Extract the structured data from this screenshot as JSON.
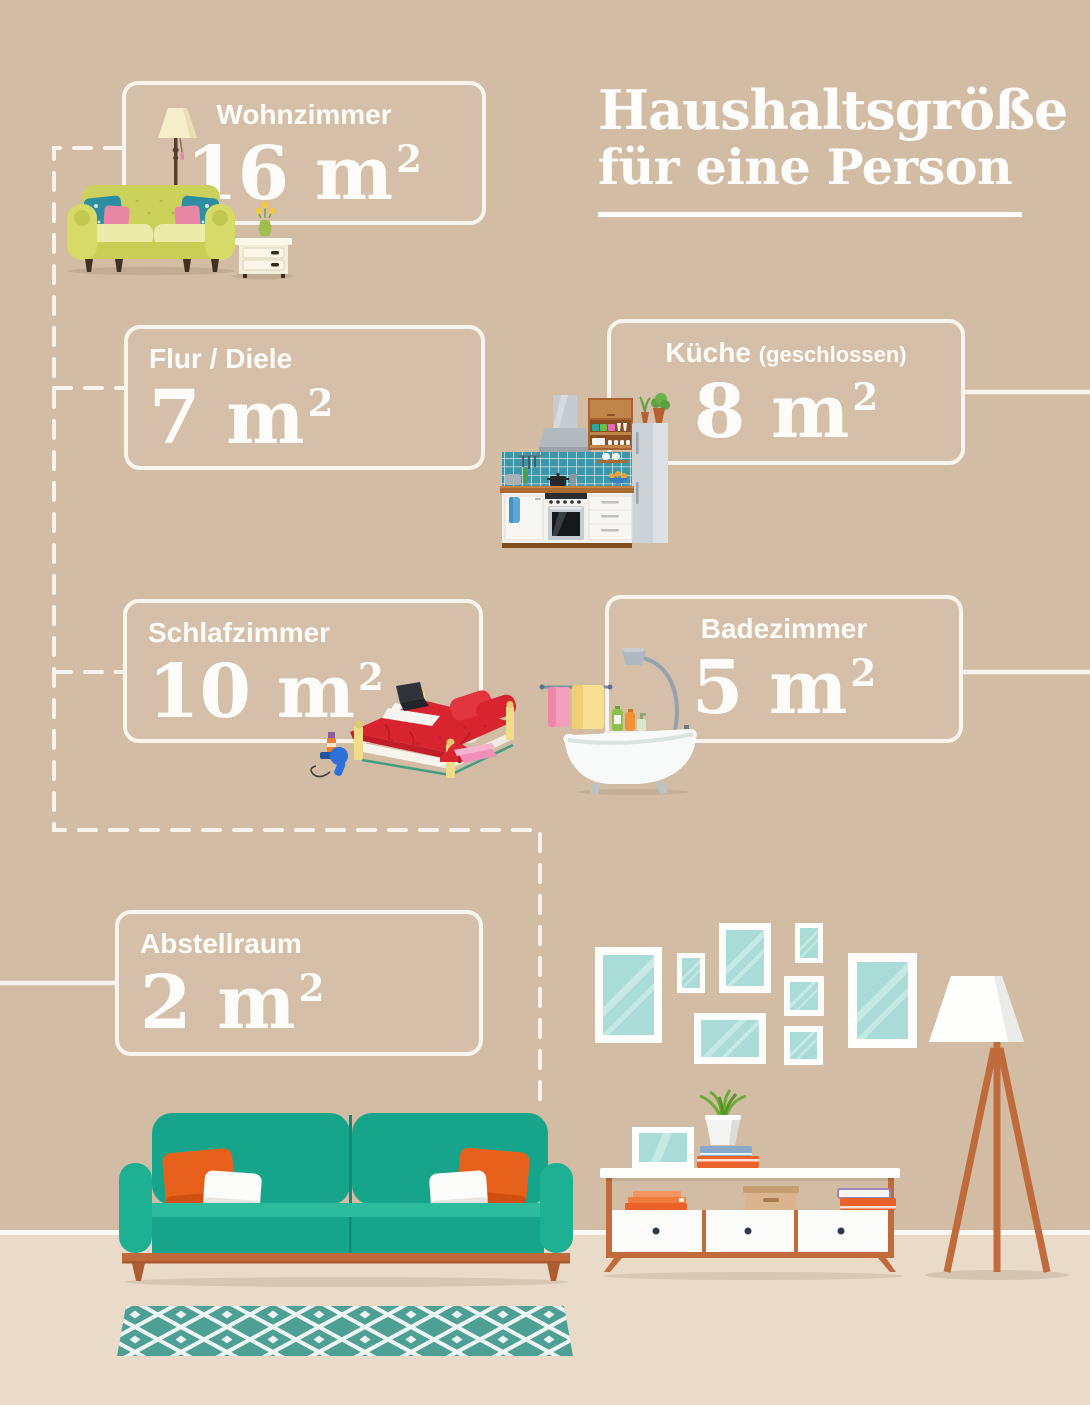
{
  "title": {
    "line1": "Haushaltsgröße",
    "line2": "für eine Person"
  },
  "rooms": [
    {
      "id": "wohnzimmer",
      "label": "Wohnzimmer",
      "size": "16 m",
      "sup": "2"
    },
    {
      "id": "flur-diele",
      "label": "Flur / Diele",
      "size": "7 m",
      "sup": "2"
    },
    {
      "id": "kueche",
      "label": "Küche",
      "note": "(geschlossen)",
      "size": "8 m",
      "sup": "2"
    },
    {
      "id": "schlafzimmer",
      "label": "Schlafzimmer",
      "size": "10 m",
      "sup": "2"
    },
    {
      "id": "badezimmer",
      "label": "Badezimmer",
      "size": "5 m",
      "sup": "2"
    },
    {
      "id": "abstellraum",
      "label": "Abstellraum",
      "size": "2 m",
      "sup": "2"
    }
  ],
  "colors": {
    "wall": "#d3bca4",
    "floor": "#e9dbc7",
    "line_white": "#f8f5ee",
    "teal_sofa": "#16a58b",
    "terracotta": "#bf6b3c",
    "orange_pillow": "#e8611c",
    "frame_glass": "#a9dcd6",
    "rug_teal": "#4da093",
    "bed_red": "#d8242f",
    "kitchen_tile": "#3e96a9",
    "top_sofa_green": "#c9cf54"
  },
  "icons": {
    "living_room": "sofa-lamp-side-table-illustration",
    "kitchen": "kitchen-unit-illustration",
    "bedroom": "bed-illustration",
    "bathroom": "bathtub-shower-illustration",
    "gallery": "picture-frame",
    "floor_lamp": "tripod-floor-lamp-illustration",
    "sideboard": "sideboard-illustration",
    "sofa": "teal-sofa-illustration",
    "rug": "patterned-rug-illustration"
  }
}
